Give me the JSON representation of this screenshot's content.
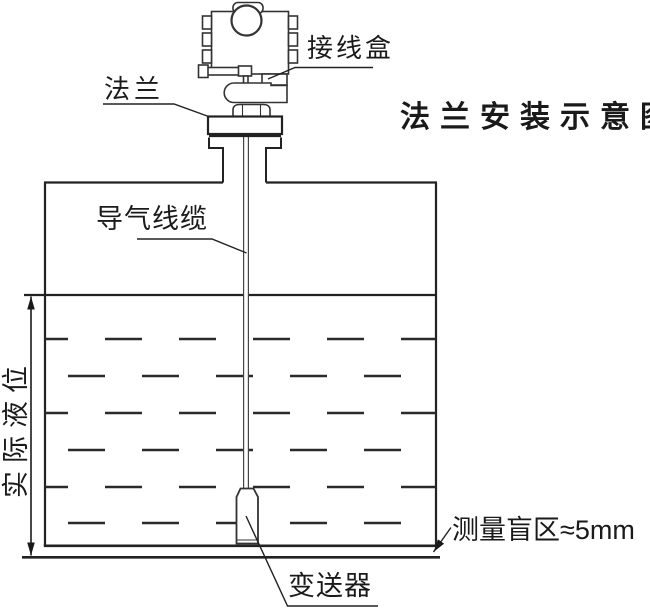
{
  "title": "法兰安装示意图",
  "labels": {
    "junction_box": "接线盒",
    "flange": "法兰",
    "air_cable": "导气线缆",
    "actual_level": "实际液位",
    "blind_zone": "测量盲区≈5mm",
    "transmitter": "变送器"
  },
  "colors": {
    "line": "#222222",
    "background": "#ffffff"
  }
}
